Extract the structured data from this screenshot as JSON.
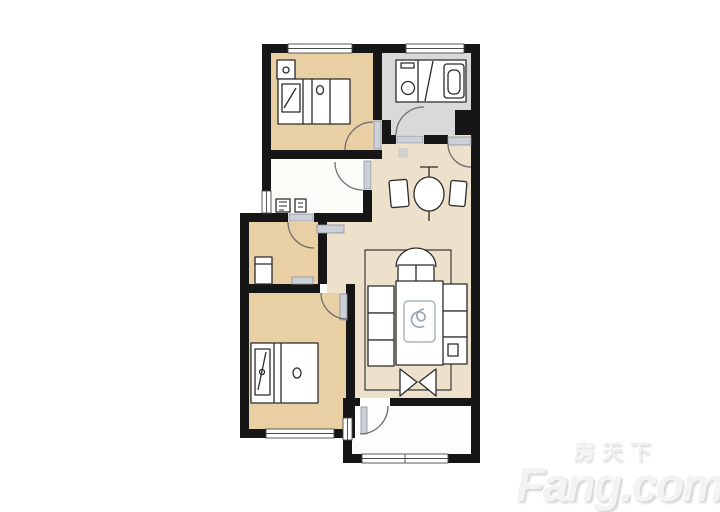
{
  "watermark": {
    "cn_text": "房天下",
    "latin_text": "Fang.com"
  },
  "palette": {
    "wall": "#161616",
    "bedroom_fill": "#e9cfa4",
    "hall_fill": "#ede1cb",
    "bathroom_fill": "#d9d9d9",
    "kitchen_fill": "#fbfbf8",
    "balcony_fill": "#fdfdfd",
    "door_panel": "#ccd1d9",
    "arc_line": "#6f6f6f",
    "furniture_line": "#2b2b2b",
    "watermark_gray": "#f1f1f1"
  }
}
